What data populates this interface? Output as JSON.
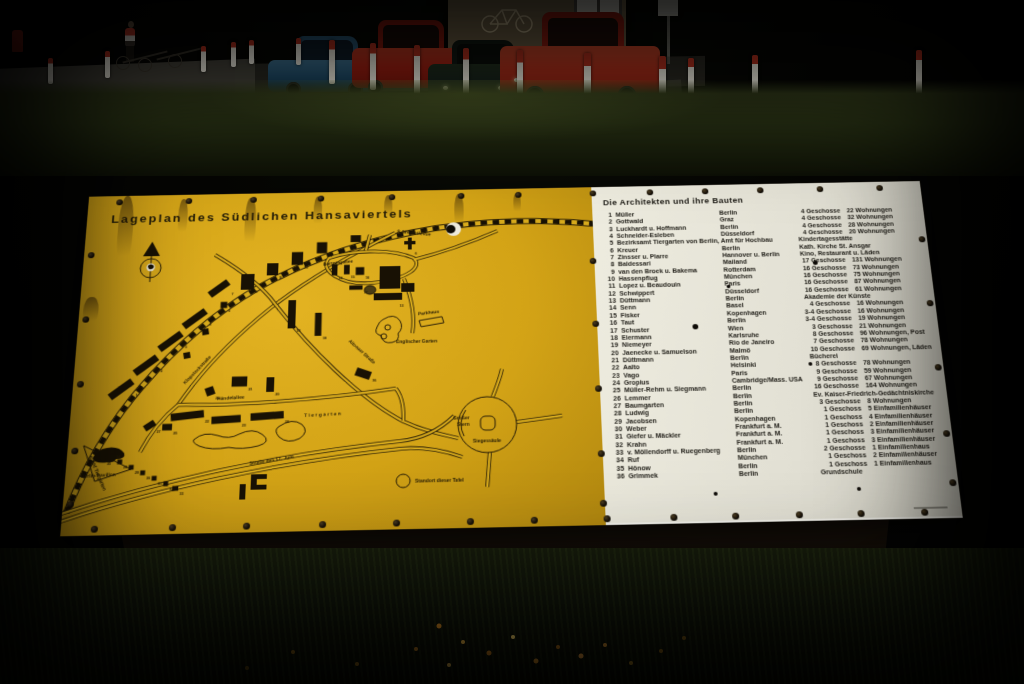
{
  "colors": {
    "panel_yellow": "#d7a71a",
    "panel_white": "#e7e6dd",
    "map_ink": "#1d1506",
    "bollard_red": "#b8321f",
    "car_blue": "#1e4a66",
    "car_red": "#a81f12"
  },
  "sign": {
    "map_panel": {
      "title": "Lageplan des Südlichen Hansaviertels",
      "labels": [
        {
          "t": "S-Bhf Bellevue",
          "x": 334,
          "y": 50,
          "r": 7,
          "s": 5.2
        },
        {
          "t": "S-Bhf Tiergarten",
          "x": 22,
          "y": 294,
          "r": 64,
          "s": 5.2
        },
        {
          "t": "Bartningallee",
          "x": 256,
          "y": 87,
          "r": -6,
          "s": 5
        },
        {
          "t": "Klopstockstraße",
          "x": 116,
          "y": 218,
          "r": -49,
          "s": 5
        },
        {
          "t": "Altonaer Straße",
          "x": 284,
          "y": 174,
          "r": 44,
          "s": 5
        },
        {
          "t": "Händelallee",
          "x": 150,
          "y": 236,
          "r": -3,
          "s": 5
        },
        {
          "t": "Straße des 17. Juni",
          "x": 186,
          "y": 306,
          "r": -8,
          "s": 5
        },
        {
          "t": "Tiergarten",
          "x": 240,
          "y": 256,
          "r": -2,
          "s": 5,
          "ls": 1.5
        },
        {
          "t": "Englischer Garten",
          "x": 334,
          "y": 177,
          "r": 0,
          "s": 5
        },
        {
          "t": "Parkhaus",
          "x": 357,
          "y": 146,
          "r": -6,
          "s": 5
        },
        {
          "t": "Großer",
          "x": 393,
          "y": 262,
          "r": 0,
          "s": 5
        },
        {
          "t": "Stern",
          "x": 397,
          "y": 269,
          "r": 0,
          "s": 5
        },
        {
          "t": "Siegessäule",
          "x": 413,
          "y": 287,
          "r": 0,
          "s": 5
        },
        {
          "t": "Berlin-Pavillon",
          "x": 16,
          "y": 316,
          "r": -2,
          "s": 5
        },
        {
          "t": "Standort dieser Tafel",
          "x": 354,
          "y": 328,
          "r": 0,
          "s": 5
        }
      ],
      "buildings": [
        {
          "n": "1",
          "x": 50,
          "y": 222,
          "w": 28,
          "h": 8,
          "r": -38
        },
        {
          "n": "2",
          "x": 74,
          "y": 196,
          "w": 28,
          "h": 8,
          "r": -38
        },
        {
          "n": "3",
          "x": 98,
          "y": 170,
          "w": 28,
          "h": 8,
          "r": -38
        },
        {
          "n": "4",
          "x": 122,
          "y": 145,
          "w": 28,
          "h": 8,
          "r": -38
        },
        {
          "n": "5",
          "x": 152,
          "y": 130,
          "w": 7,
          "h": 7,
          "r": 0
        },
        {
          "n": "7",
          "x": 146,
          "y": 111,
          "w": 24,
          "h": 8,
          "r": -38
        },
        {
          "n": "",
          "x": 116,
          "y": 186,
          "w": 7,
          "h": 7,
          "r": -10
        },
        {
          "n": "",
          "x": 134,
          "y": 160,
          "w": 7,
          "h": 7,
          "r": -10
        },
        {
          "n": "8",
          "x": 176,
          "y": 104,
          "w": 14,
          "h": 18,
          "r": 0
        },
        {
          "n": "9",
          "x": 202,
          "y": 90,
          "w": 12,
          "h": 14,
          "r": 0
        },
        {
          "n": "10",
          "x": 228,
          "y": 78,
          "w": 12,
          "h": 15,
          "r": 0
        },
        {
          "n": "11",
          "x": 254,
          "y": 66,
          "w": 11,
          "h": 13,
          "r": 0
        },
        {
          "n": "12",
          "x": 290,
          "y": 56,
          "w": 11,
          "h": 8,
          "r": 0
        },
        {
          "n": "14",
          "x": 268,
          "y": 92,
          "w": 6,
          "h": 13,
          "r": 0
        },
        {
          "n": "15",
          "x": 281,
          "y": 92,
          "w": 6,
          "h": 11,
          "r": 0
        },
        {
          "n": "16",
          "x": 295,
          "y": 94,
          "w": 9,
          "h": 9,
          "r": 0
        },
        {
          "n": "17",
          "x": 291,
          "y": 113,
          "w": 14,
          "h": 5,
          "r": 0
        },
        {
          "n": "18",
          "x": 224,
          "y": 142,
          "w": 8,
          "h": 32,
          "r": 0
        },
        {
          "n": "19",
          "x": 252,
          "y": 154,
          "w": 7,
          "h": 26,
          "r": 0
        },
        {
          "n": "20",
          "x": 204,
          "y": 220,
          "w": 8,
          "h": 16,
          "r": 0
        },
        {
          "n": "21",
          "x": 172,
          "y": 216,
          "w": 16,
          "h": 11,
          "r": 0
        },
        {
          "n": "22",
          "x": 120,
          "y": 252,
          "w": 34,
          "h": 8,
          "r": -6
        },
        {
          "n": "23",
          "x": 160,
          "y": 257,
          "w": 30,
          "h": 8,
          "r": -3
        },
        {
          "n": "24",
          "x": 202,
          "y": 254,
          "w": 34,
          "h": 8,
          "r": -3
        },
        {
          "n": "25",
          "x": 100,
          "y": 264,
          "w": 10,
          "h": 7,
          "r": 0
        },
        {
          "n": "26",
          "x": 142,
          "y": 226,
          "w": 9,
          "h": 9,
          "r": -20
        },
        {
          "n": "27",
          "x": 82,
          "y": 262,
          "w": 12,
          "h": 7,
          "r": -35
        },
        {
          "n": "28",
          "x": 54,
          "y": 300,
          "w": 5,
          "h": 5,
          "r": 0
        },
        {
          "n": "29",
          "x": 66,
          "y": 306,
          "w": 5,
          "h": 5,
          "r": 0
        },
        {
          "n": "30",
          "x": 78,
          "y": 312,
          "w": 5,
          "h": 5,
          "r": 0
        },
        {
          "n": "31",
          "x": 90,
          "y": 318,
          "w": 5,
          "h": 5,
          "r": 0
        },
        {
          "n": "32",
          "x": 102,
          "y": 324,
          "w": 5,
          "h": 5,
          "r": 0
        },
        {
          "n": "33",
          "x": 112,
          "y": 329,
          "w": 6,
          "h": 5,
          "r": 0
        },
        {
          "n": "34",
          "x": 46,
          "y": 289,
          "w": 5,
          "h": 5,
          "r": 0
        },
        {
          "n": "35",
          "x": 37,
          "y": 296,
          "w": 5,
          "h": 5,
          "r": 0
        },
        {
          "n": "36",
          "x": 300,
          "y": 210,
          "w": 16,
          "h": 9,
          "r": 20
        },
        {
          "n": "6",
          "x": 352,
          "y": 72,
          "w": 0,
          "h": 0,
          "r": 0
        },
        {
          "n": "13",
          "x": 336,
          "y": 132,
          "w": 0,
          "h": 0,
          "r": 0
        }
      ]
    },
    "list_panel": {
      "title": "Die Architekten und ihre Bauten",
      "rows": [
        {
          "no": "1",
          "architect": "Müller",
          "city": "Berlin",
          "floors": "4 Geschosse",
          "units": "22 Wohnungen"
        },
        {
          "no": "2",
          "architect": "Gottwald",
          "city": "Graz",
          "floors": "4 Geschosse",
          "units": "32 Wohnungen"
        },
        {
          "no": "3",
          "architect": "Luckhardt u. Hoffmann",
          "city": "Berlin",
          "floors": "4 Geschosse",
          "units": "28 Wohnungen"
        },
        {
          "no": "4",
          "architect": "Schneider-Esleben",
          "city": "Düsseldorf",
          "floors": "4 Geschosse",
          "units": "20 Wohnungen"
        },
        {
          "no": "5",
          "architect": "Bezirksamt Tiergarten von Berlin, Amt für Hochbau",
          "city": "",
          "special": "Kindertagesstätte"
        },
        {
          "no": "6",
          "architect": "Kreuer",
          "city": "Berlin",
          "special": "Kath. Kirche St. Ansgar"
        },
        {
          "no": "7",
          "architect": "Zinsser u. Plarre",
          "city": "Hannover u. Berlin",
          "special": "Kino, Restaurant u. Läden"
        },
        {
          "no": "8",
          "architect": "Baldessari",
          "city": "Mailand",
          "floors": "17 Geschosse",
          "units": "131 Wohnungen"
        },
        {
          "no": "9",
          "architect": "van den Broek u. Bakema",
          "city": "Rotterdam",
          "floors": "16 Geschosse",
          "units": "73 Wohnungen"
        },
        {
          "no": "10",
          "architect": "Hassenpflug",
          "city": "München",
          "floors": "16 Geschosse",
          "units": "75 Wohnungen"
        },
        {
          "no": "11",
          "architect": "Lopez u. Beaudouin",
          "city": "Paris",
          "floors": "16 Geschosse",
          "units": "87 Wohnungen"
        },
        {
          "no": "12",
          "architect": "Schwippert",
          "city": "Düsseldorf",
          "floors": "16 Geschosse",
          "units": "61 Wohnungen"
        },
        {
          "no": "13",
          "architect": "Düttmann",
          "city": "Berlin",
          "special": "Akademie der Künste"
        },
        {
          "no": "14",
          "architect": "Senn",
          "city": "Basel",
          "floors": "4 Geschosse",
          "units": "16 Wohnungen"
        },
        {
          "no": "15",
          "architect": "Fisker",
          "city": "Kopenhagen",
          "floors": "3-4 Geschosse",
          "units": "16 Wohnungen"
        },
        {
          "no": "16",
          "architect": "Taut",
          "city": "Berlin",
          "floors": "3-4 Geschosse",
          "units": "19 Wohnungen"
        },
        {
          "no": "17",
          "architect": "Schuster",
          "city": "Wien",
          "floors": "3 Geschosse",
          "units": "21 Wohnungen"
        },
        {
          "no": "18",
          "architect": "Eiermann",
          "city": "Karlsruhe",
          "floors": "8 Geschosse",
          "units": "96 Wohnungen, Post"
        },
        {
          "no": "19",
          "architect": "Niemeyer",
          "city": "Rio de Janeiro",
          "floors": "7 Geschosse",
          "units": "78 Wohnungen"
        },
        {
          "no": "20",
          "architect": "Jaenecke u. Samuelson",
          "city": "Malmö",
          "floors": "10 Geschosse",
          "units": "69 Wohnungen, Läden"
        },
        {
          "no": "21",
          "architect": "Düttmann",
          "city": "Berlin",
          "special": "Bücherei"
        },
        {
          "no": "22",
          "architect": "Aalto",
          "city": "Helsinki",
          "floors": "8 Geschosse",
          "units": "78 Wohnungen"
        },
        {
          "no": "23",
          "architect": "Vago",
          "city": "Paris",
          "floors": "9 Geschosse",
          "units": "59 Wohnungen"
        },
        {
          "no": "24",
          "architect": "Gropius",
          "city": "Cambridge/Mass. USA",
          "floors": "9 Geschosse",
          "units": "67 Wohnungen"
        },
        {
          "no": "25",
          "architect": "Müller-Rehm u. Siegmann",
          "city": "Berlin",
          "floors": "16 Geschosse",
          "units": "164 Wohnungen"
        },
        {
          "no": "26",
          "architect": "Lemmer",
          "city": "Berlin",
          "special": "Ev. Kaiser-Friedrich-Gedächtniskirche"
        },
        {
          "no": "27",
          "architect": "Baumgarten",
          "city": "Berlin",
          "floors": "3 Geschosse",
          "units": "8 Wohnungen"
        },
        {
          "no": "28",
          "architect": "Ludwig",
          "city": "Berlin",
          "floors": "1 Geschoss",
          "units": "5 Einfamilienhäuser"
        },
        {
          "no": "29",
          "architect": "Jacobsen",
          "city": "Kopenhagen",
          "floors": "1 Geschoss",
          "units": "4 Einfamilienhäuser"
        },
        {
          "no": "30",
          "architect": "Weber",
          "city": "Frankfurt a. M.",
          "floors": "1 Geschoss",
          "units": "2 Einfamilienhäuser"
        },
        {
          "no": "31",
          "architect": "Giefer u. Mäckler",
          "city": "Frankfurt a. M.",
          "floors": "1 Geschoss",
          "units": "3 Einfamilienhäuser"
        },
        {
          "no": "32",
          "architect": "Krahn",
          "city": "Frankfurt a. M.",
          "floors": "1 Geschoss",
          "units": "3 Einfamilienhäuser"
        },
        {
          "no": "33",
          "architect": "v. Möllendorff u. Ruegenberg",
          "city": "Berlin",
          "floors": "2 Geschosse",
          "units": "1 Einfamilienhaus"
        },
        {
          "no": "34",
          "architect": "Ruf",
          "city": "München",
          "floors": "1 Geschoss",
          "units": "2 Einfamilienhäuser"
        },
        {
          "no": "35",
          "architect": "Hönow",
          "city": "Berlin",
          "floors": "1 Geschoss",
          "units": "1 Einfamilienhaus"
        },
        {
          "no": "36",
          "architect": "Grimmek",
          "city": "Berlin",
          "special": "Grundschule"
        }
      ]
    }
  }
}
